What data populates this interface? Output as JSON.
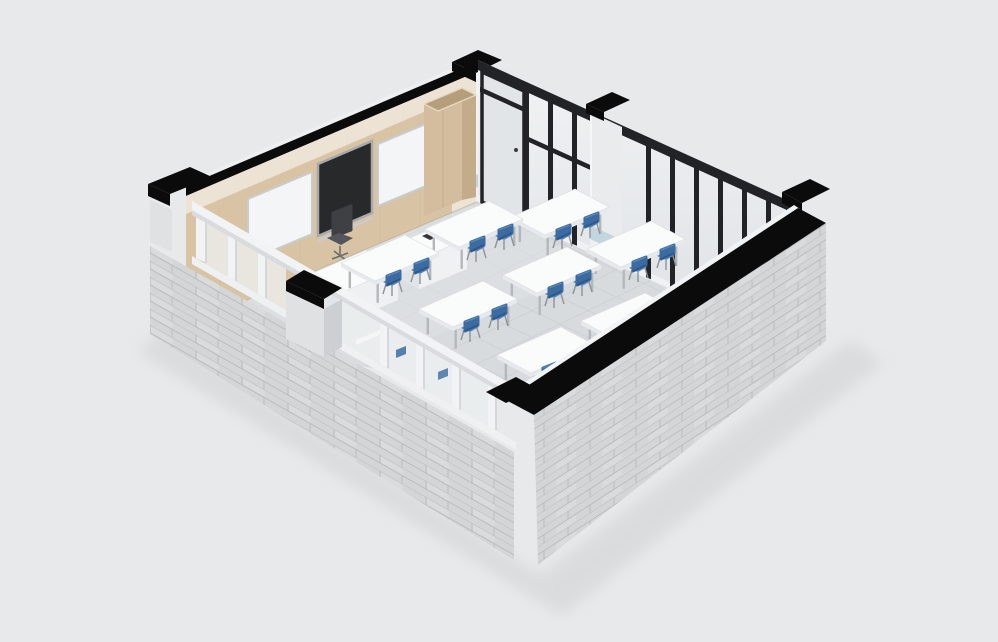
{
  "meta": {
    "description": "3D isometric cutaway render of a classroom with stone exterior walls, wood-panel teaching wall, glass partition and rows of student desks",
    "render_style": "isometric architectural visualization",
    "visible_text": ""
  },
  "colors": {
    "bg": "#e8e9ea",
    "shadow": "#cfd1d3",
    "stone": "#d3d5d6",
    "stone_light": "#dfe1e2",
    "stone_joint": "#b7babc",
    "black_cut": "#0b0b0c",
    "frame_black": "#212326",
    "trim_white": "#f2f3f4",
    "wall_cream": "#ece3d4",
    "wood": "#d8c3a5",
    "wood_dark": "#c4ac8a",
    "wood_top": "#b69d7c",
    "wood_grain": "#c9b294",
    "board_white": "#f4f5f6",
    "board_frame": "#c9ccce",
    "screen_dark": "#28292b",
    "screen_frame": "#a6aaad",
    "glass_hi": "#f1f3f4",
    "glass_lo": "#dde1e4",
    "door_pane": "#e2e5e7",
    "column_face": "#e9ebec",
    "wainscot_blue": "#c3d6de",
    "floor": "#d8dbdd",
    "floor_line": "#c7cbce",
    "floor_sheen": "#e2e5e6",
    "desk_top": "#fafbfb",
    "desk_side": "#e7eaec",
    "desk_leg": "#b4b8bb",
    "chair_blue": "#3b6ba1",
    "chair_blue_light": "#5a87b9",
    "chair_blue_dark": "#2f5684",
    "chair_leg": "#8e9398",
    "teacher_chair": "#3f4044",
    "teacher_chair_seat": "#53555a"
  },
  "scene": {
    "room_type": "classroom",
    "floor": {
      "material": "light gray tile"
    },
    "teaching_wall": {
      "material": "wood paneling",
      "whiteboards": 2,
      "display_screen": 1,
      "cabinet": 1,
      "upper_band": "cream"
    },
    "glass_partition": {
      "frame_color_name": "black",
      "door_count": 1,
      "column_count": 1,
      "mullion_x": [
        524,
        548,
        572,
        646,
        670,
        694,
        718,
        742,
        766,
        786
      ],
      "transoms": [
        {
          "x1": 480,
          "x2": 524,
          "dy": 26
        },
        {
          "x1": 524,
          "x2": 594,
          "dy": 54
        },
        {
          "x1": 766,
          "x2": 788,
          "dy": 86
        }
      ]
    },
    "window_wall": {
      "window_count": 7,
      "pillar_count": 1,
      "frame_color_name": "white"
    },
    "exterior_walls": {
      "material": "stone block",
      "cut_top_color_name": "black"
    },
    "furniture": {
      "teacher_chair_count": 1,
      "teacher_desk_count": 1,
      "podium_count": 1,
      "podium_tablet_count": 1,
      "student_desks": {
        "count": 9,
        "chairs_per_desk": 2,
        "positions": [
          [
            390,
            258
          ],
          [
            474,
            224
          ],
          [
            560,
            212
          ],
          [
            468,
            304
          ],
          [
            552,
            270
          ],
          [
            636,
            244
          ],
          [
            546,
            350
          ],
          [
            630,
            316
          ],
          [
            714,
            284
          ]
        ],
        "chair_offsets": [
          [
            4,
            22
          ],
          [
            32,
            10
          ]
        ]
      }
    }
  }
}
